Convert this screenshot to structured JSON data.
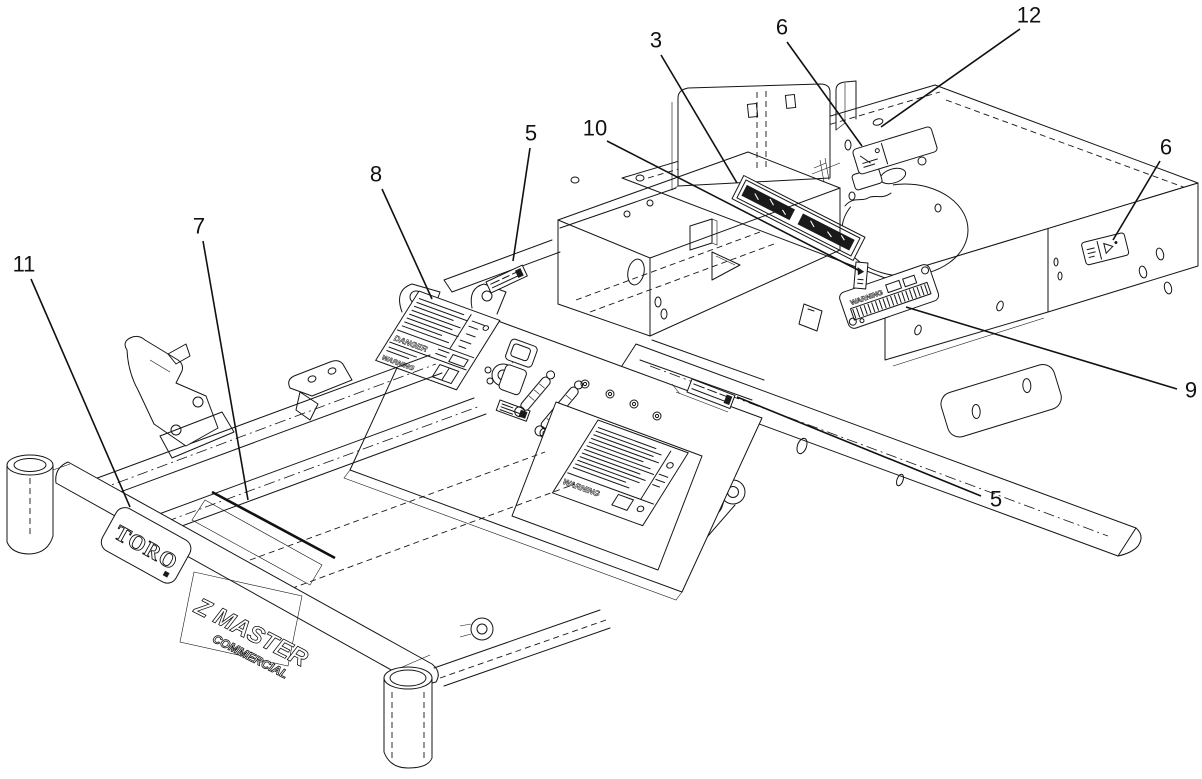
{
  "figure": {
    "background": "#ffffff",
    "line_color": "#151515"
  },
  "branding": {
    "logo": "TORO",
    "model": "Z MASTER",
    "model_sub": "COMMERCIAL"
  },
  "decal_words": {
    "danger": "DANGER",
    "warning": "WARNING"
  },
  "callouts": [
    {
      "label": "3",
      "tx": 656,
      "ty": 40,
      "x1": 661,
      "y1": 55,
      "x2": 737,
      "y2": 183
    },
    {
      "label": "6",
      "tx": 782,
      "ty": 27,
      "x1": 787,
      "y1": 42,
      "x2": 862,
      "y2": 146
    },
    {
      "label": "12",
      "tx": 1029,
      "ty": 15,
      "x1": 1020,
      "y1": 29,
      "x2": 881,
      "y2": 127
    },
    {
      "label": "6",
      "tx": 1166,
      "ty": 147,
      "x1": 1160,
      "y1": 161,
      "x2": 1113,
      "y2": 240
    },
    {
      "label": "5",
      "tx": 531,
      "ty": 133,
      "x1": 530,
      "y1": 148,
      "x2": 513,
      "y2": 261
    },
    {
      "label": "10",
      "tx": 595,
      "ty": 128,
      "x1": 607,
      "y1": 141,
      "x2": 860,
      "y2": 271
    },
    {
      "label": "8",
      "tx": 376,
      "ty": 174,
      "x1": 382,
      "y1": 189,
      "x2": 432,
      "y2": 299
    },
    {
      "label": "7",
      "tx": 199,
      "ty": 226,
      "x1": 203,
      "y1": 241,
      "x2": 248,
      "y2": 500
    },
    {
      "label": "11",
      "tx": 24,
      "ty": 264,
      "x1": 31,
      "y1": 279,
      "x2": 130,
      "y2": 507
    },
    {
      "label": "9",
      "tx": 1191,
      "ty": 390,
      "x1": 1177,
      "y1": 389,
      "x2": 906,
      "y2": 307
    },
    {
      "label": "5",
      "tx": 996,
      "ty": 499,
      "x1": 981,
      "y1": 496,
      "x2": 737,
      "y2": 397
    }
  ]
}
